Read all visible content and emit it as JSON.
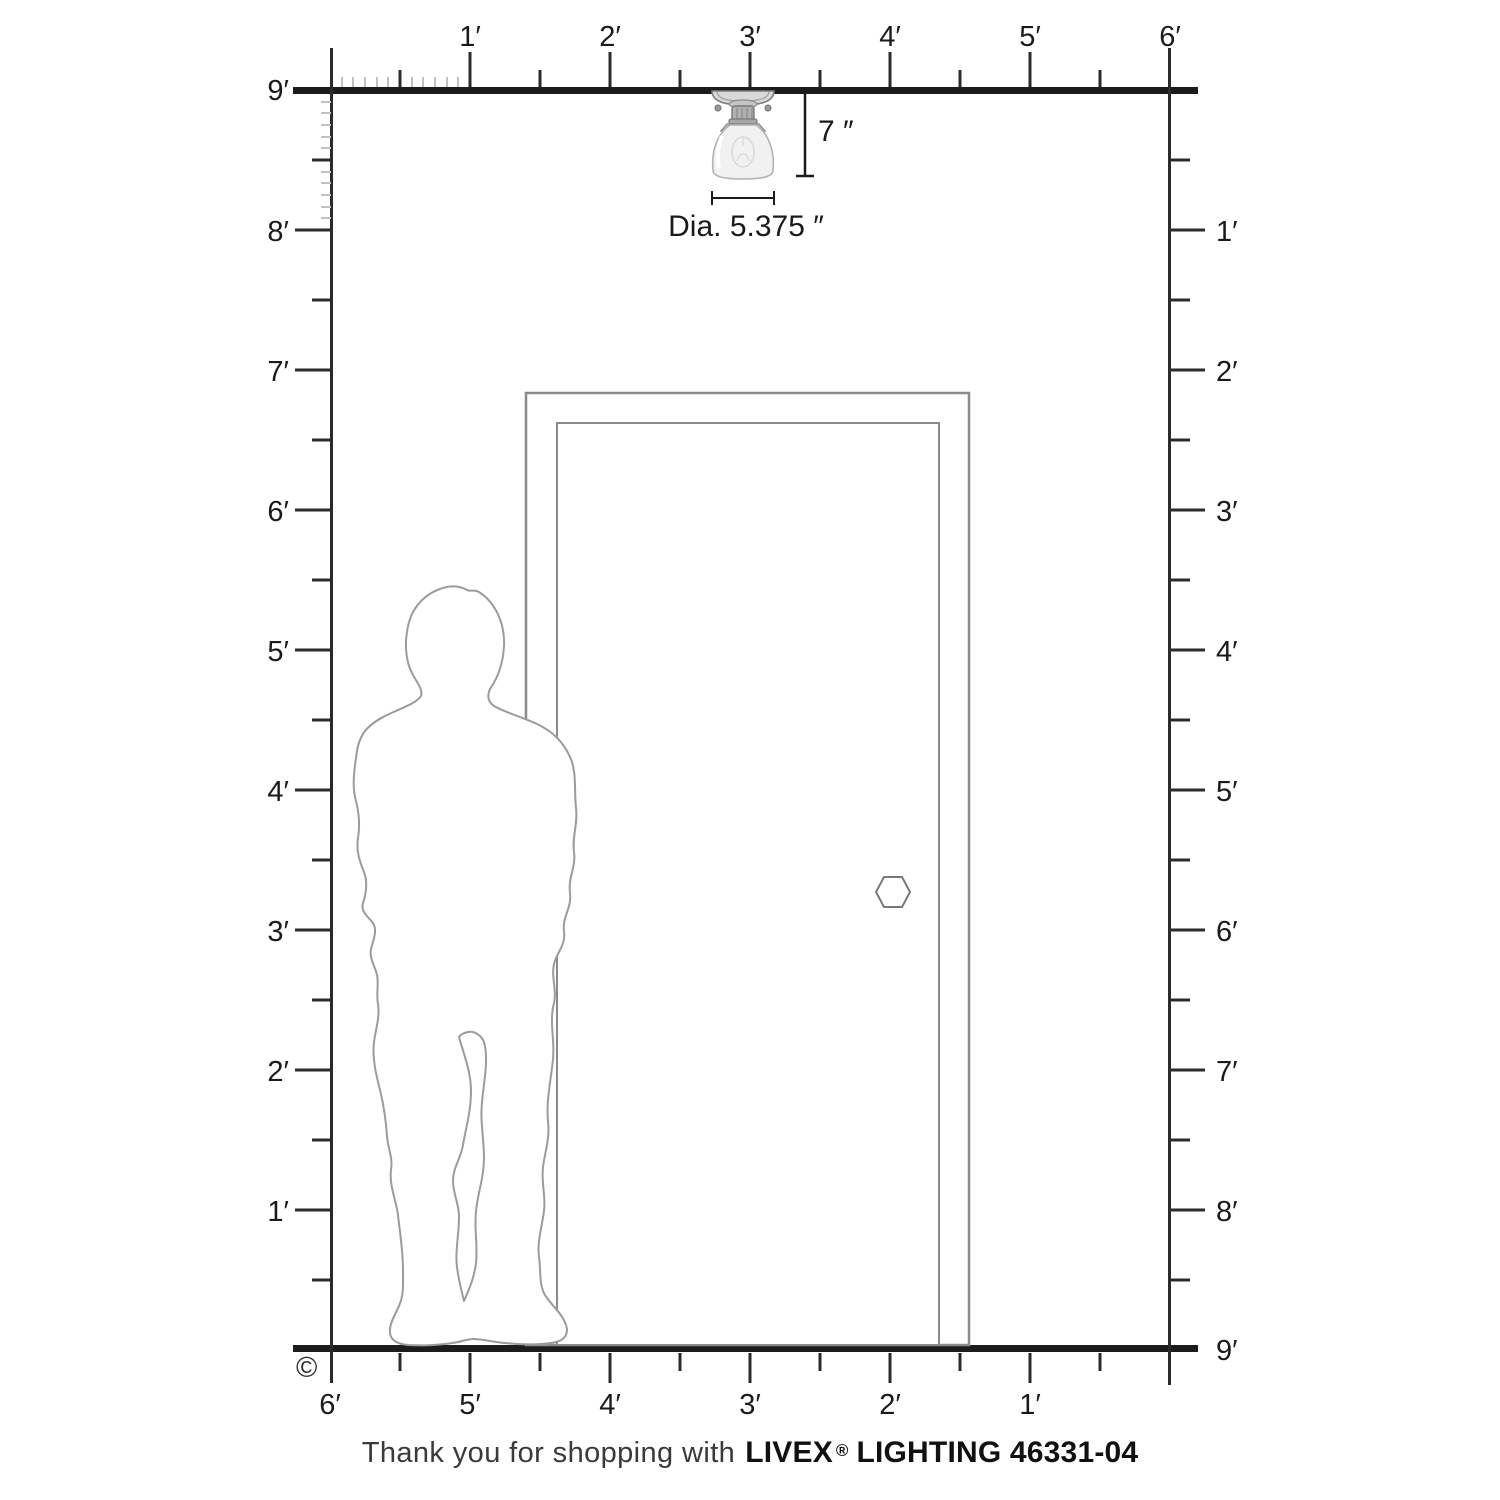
{
  "rulers": {
    "top": {
      "labels": [
        "1′",
        "2′",
        "3′",
        "4′",
        "5′",
        "6′"
      ]
    },
    "left": {
      "labels": [
        "9′",
        "8′",
        "7′",
        "6′",
        "5′",
        "4′",
        "3′",
        "2′",
        "1′"
      ]
    },
    "right": {
      "labels": [
        "1′",
        "2′",
        "3′",
        "4′",
        "5′",
        "6′",
        "7′",
        "8′",
        "9′"
      ]
    },
    "bottom": {
      "labels": [
        "6′",
        "5′",
        "4′",
        "3′",
        "2′",
        "1′"
      ]
    }
  },
  "fixture": {
    "height_label": "7 ″",
    "diameter_label": "Dia. 5.375 ″"
  },
  "footer": {
    "thanks_prefix": "Thank you for shopping with",
    "brand": "LIVEX",
    "registered_mark": "®",
    "brand_suffix": "LIGHTING 46331-04",
    "copyright_symbol": "©"
  },
  "colors": {
    "structure_line": "#1c1c1c",
    "ruler_line": "#2b2b2b",
    "inch_tick": "#c2c2c2",
    "door_outline": "#8a8a8a",
    "person_outline": "#9b9b9b"
  }
}
